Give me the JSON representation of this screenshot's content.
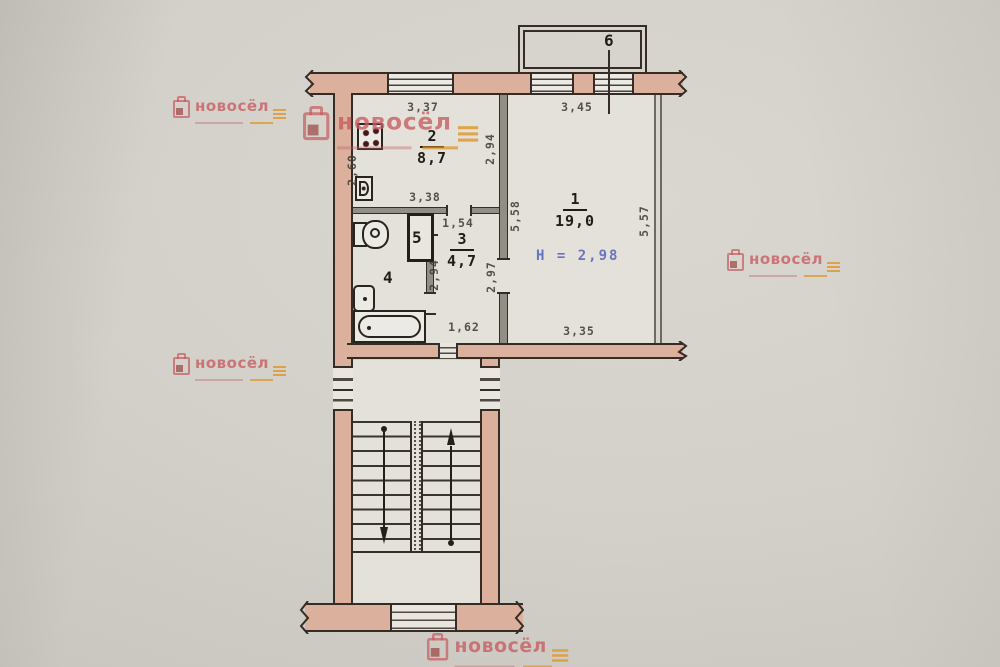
{
  "plan": {
    "rooms": [
      {
        "number": "1",
        "area": "19,0"
      },
      {
        "number": "2",
        "area": "8,7"
      },
      {
        "number": "3",
        "area": "4,7"
      },
      {
        "number": "4",
        "area": ""
      },
      {
        "number": "5",
        "area": ""
      },
      {
        "number": "6",
        "area": ""
      }
    ],
    "ceiling_height_note": "Н = 2,98",
    "dimensions": {
      "kitchen_window": "3,37",
      "room1_window": "3,45",
      "kitchen_left": "2,60",
      "kitchen_right": "2,94",
      "kitchen_bottom": "3,38",
      "hall_top": "1,54",
      "room1_left": "5,58",
      "room1_right": "5,57",
      "hall_left": "2,94",
      "hall_right": "2,97",
      "hall_bottom": "1,62",
      "room1_bottom": "3,35"
    },
    "colors": {
      "wall_fill": "#dbb19d",
      "outline": "#352c25",
      "partition": "#918e86",
      "stamp_blue": "#5f6bbd",
      "paper": "#d2cfc8",
      "interior": "#e4e1da",
      "watermark_pink": "#c65a60",
      "watermark_orange": "#de9628"
    }
  },
  "watermark": {
    "text": "новосёл"
  }
}
